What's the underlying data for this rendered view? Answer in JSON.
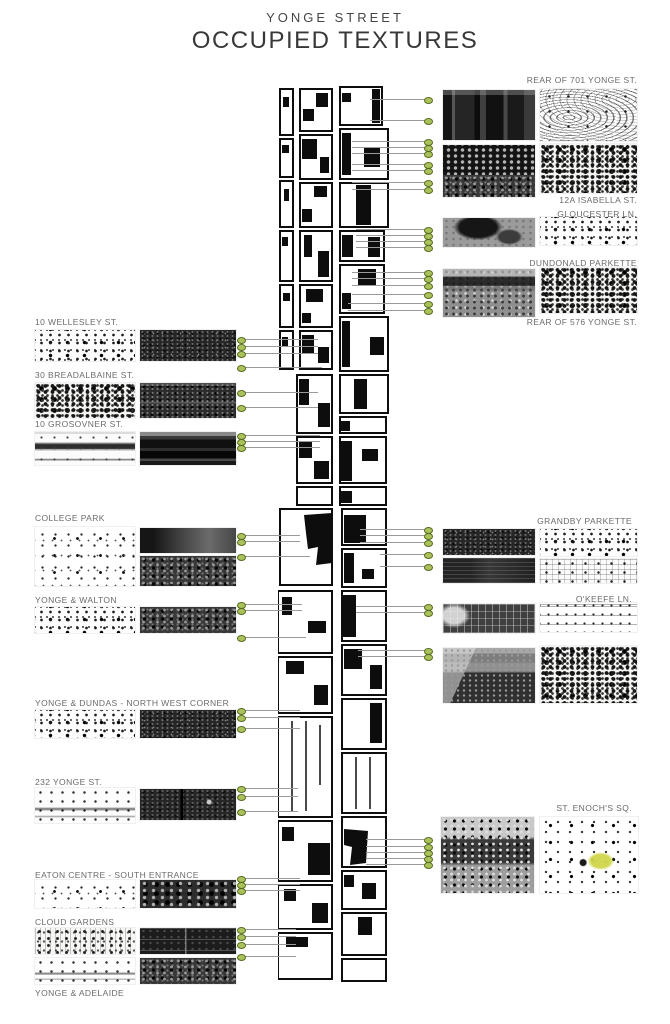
{
  "title": {
    "kicker": "YONGE STREET",
    "main": "OCCUPIED TEXTURES"
  },
  "left_items": [
    {
      "label": "10 WELLESLEY ST."
    },
    {
      "label": "30 BREADALBAINE ST."
    },
    {
      "label": "10 GROSOVNER ST."
    },
    {
      "label": "COLLEGE PARK"
    },
    {
      "label": "YONGE & WALTON"
    },
    {
      "label": "YONGE & DUNDAS - NORTH WEST CORNER"
    },
    {
      "label": "232 YONGE ST."
    },
    {
      "label": "EATON CENTRE - SOUTH ENTRANCE"
    },
    {
      "label": "CLOUD GARDENS"
    },
    {
      "label": "YONGE & ADELAIDE"
    }
  ],
  "right_items": [
    {
      "label": "REAR OF 701 YONGE ST."
    },
    {
      "label": "12A ISABELLA ST."
    },
    {
      "label": "GLOUCESTER LN."
    },
    {
      "label": "DUNDONALD PARKETTE"
    },
    {
      "label": "REAR OF 576 YONGE ST."
    },
    {
      "label": "GRANDBY PARKETTE"
    },
    {
      "label": "O'KEEFE LN."
    },
    {
      "label": "ST. ENOCH'S SQ."
    }
  ],
  "map": {
    "description": "figure-ground plan of Yonge Street corridor"
  },
  "colors": {
    "marker_fill": "#abc25c",
    "marker_stroke": "#566b1e",
    "leader_line": "#9a9a9a",
    "highlight_yellow": "#d0d64a",
    "ink": "#0d0d0d"
  }
}
